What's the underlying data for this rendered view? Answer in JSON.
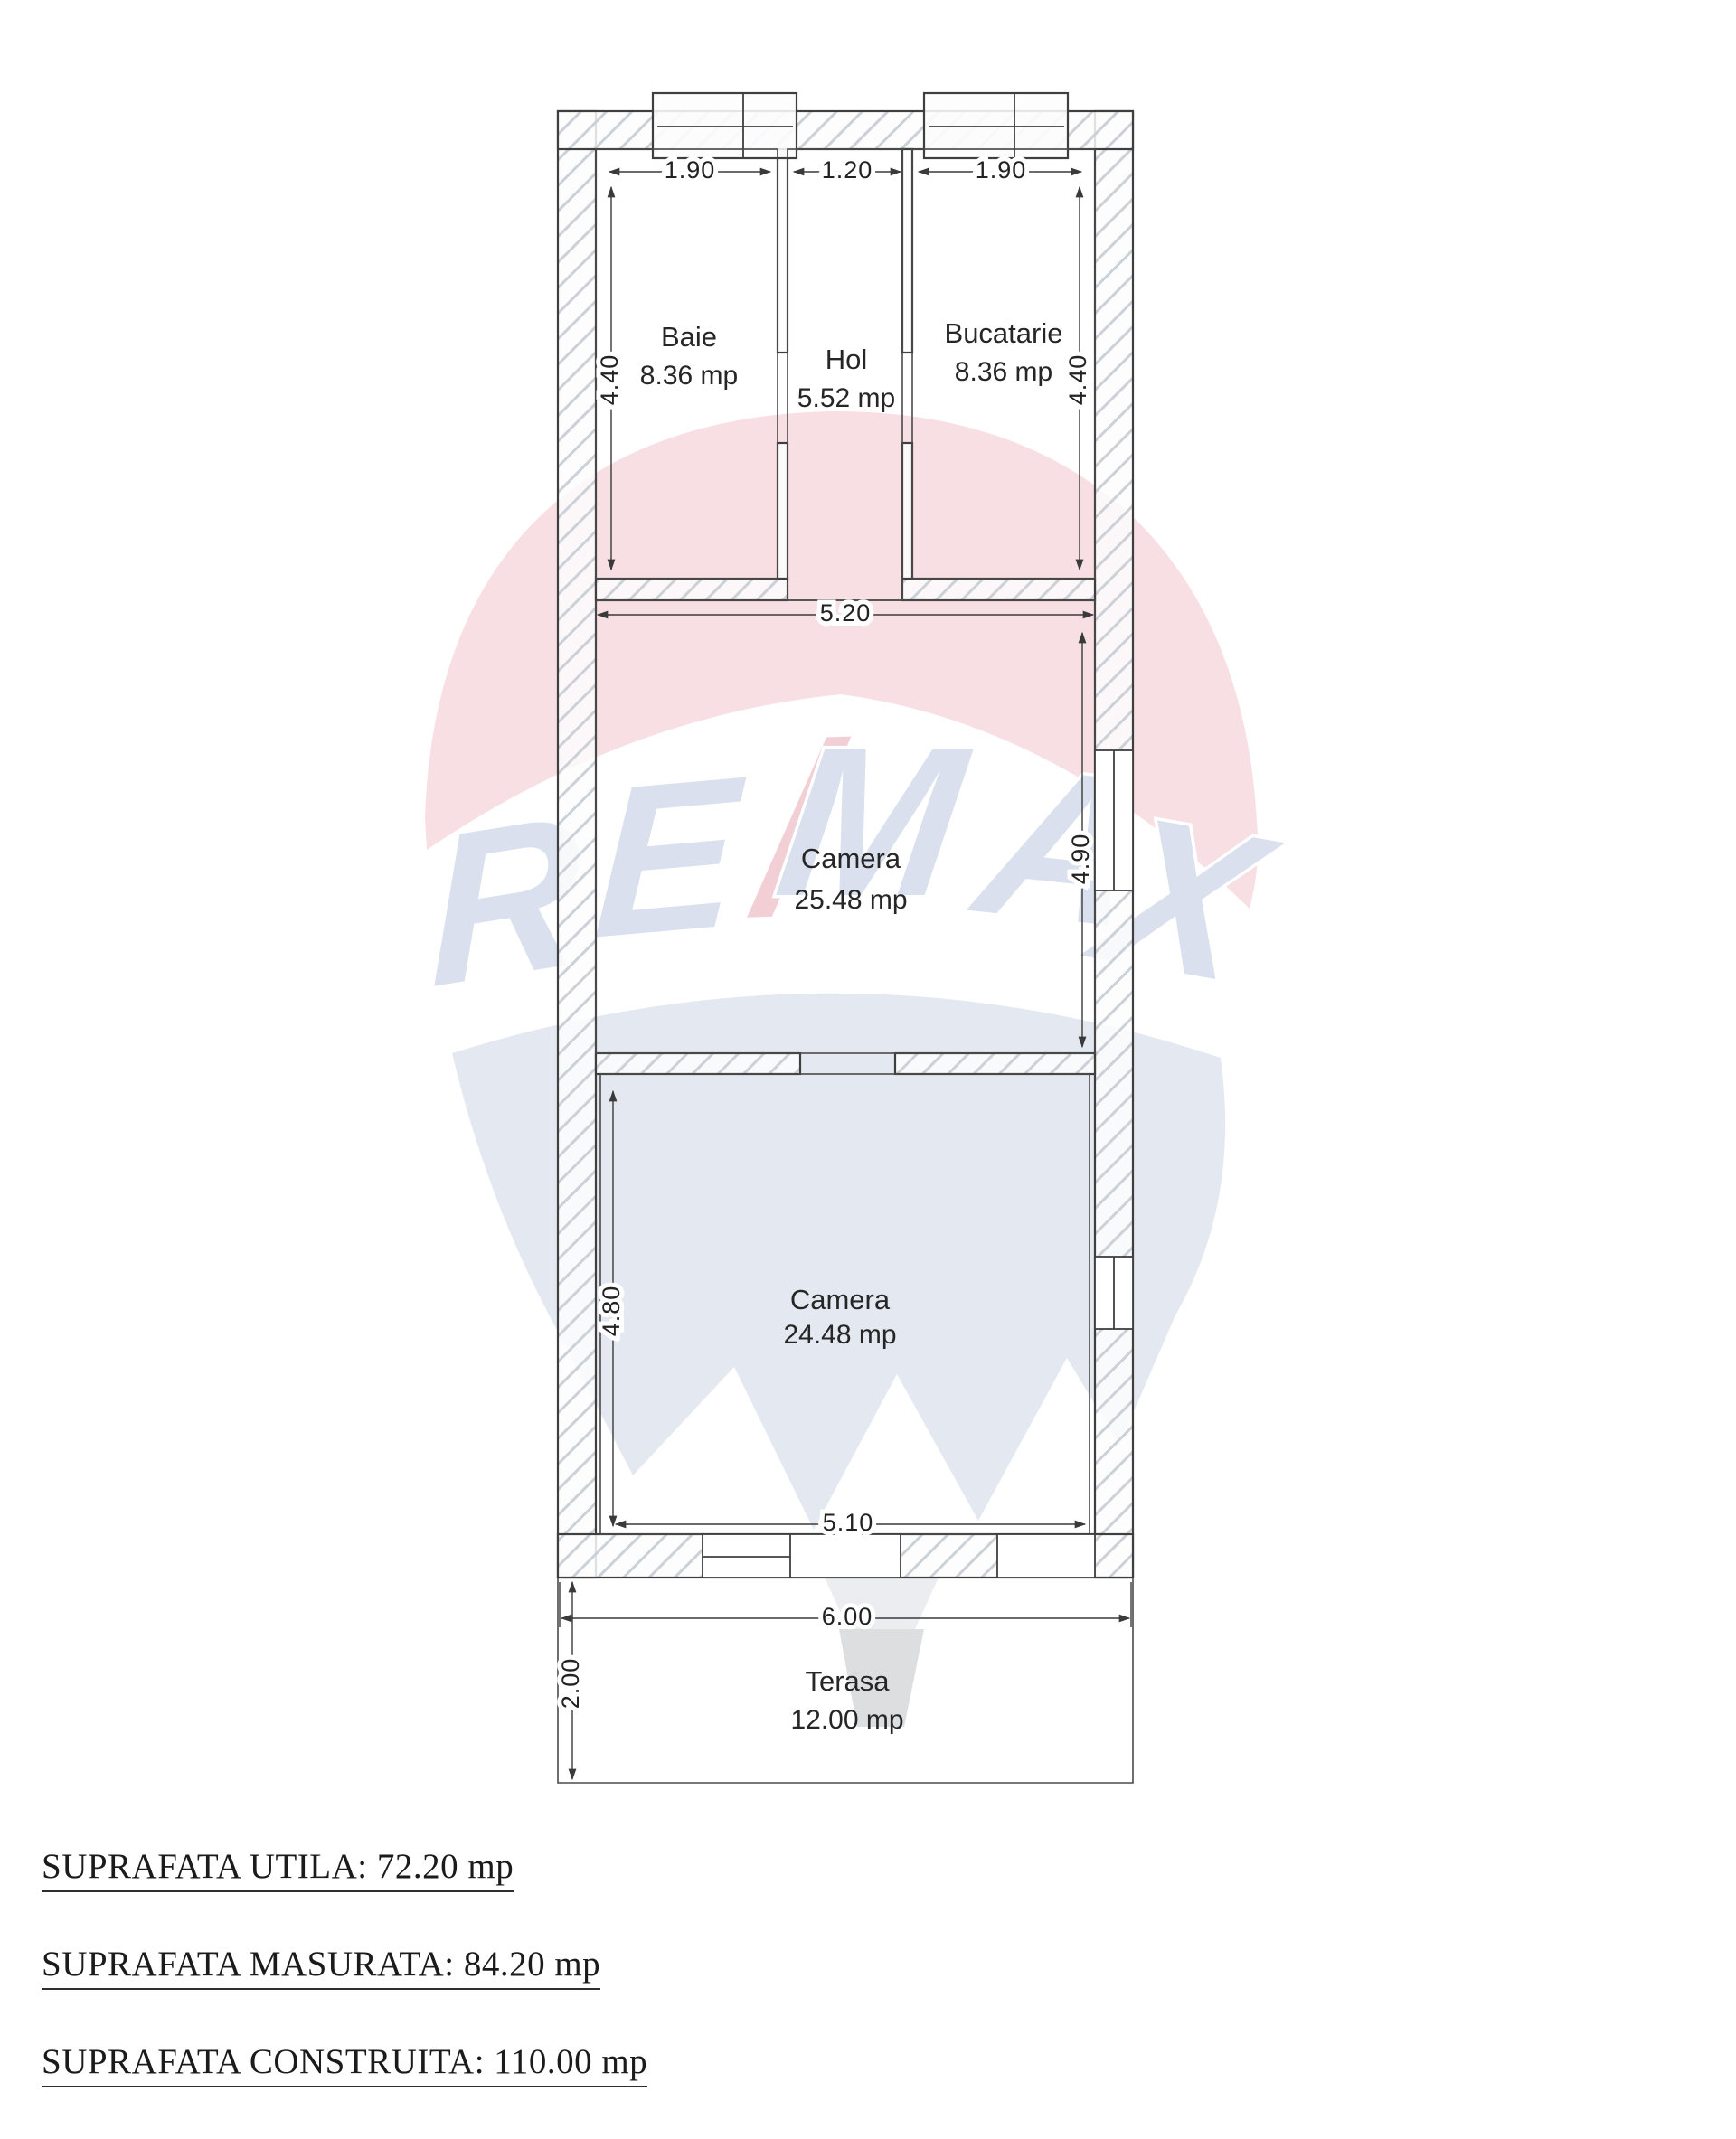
{
  "watermark": {
    "brand": "RE/MAX",
    "letters": [
      "R",
      "E",
      "/",
      "M",
      "A",
      "X"
    ],
    "colors": {
      "dome_pink": "#f7dee2",
      "letters_blue": "#d8dfec",
      "slash_pink": "#f2cdd3",
      "body_blue": "#e3e8f1",
      "basket_gray": "#dcdddf"
    }
  },
  "rooms": {
    "baie": {
      "name": "Baie",
      "area": "8.36 mp"
    },
    "hol": {
      "name": "Hol",
      "area": "5.52 mp"
    },
    "bucatarie": {
      "name": "Bucatarie",
      "area": "8.36 mp"
    },
    "camera_mare": {
      "name": "Camera",
      "area": "25.48 mp"
    },
    "camera_mica": {
      "name": "Camera",
      "area": "24.48 mp"
    },
    "terasa": {
      "name": "Terasa",
      "area": "12.00 mp"
    }
  },
  "dimensions": {
    "baie_width": "1.90",
    "hol_width": "1.20",
    "bucatarie_width": "1.90",
    "baie_height": "4.40",
    "bucatarie_height": "4.40",
    "camera_mare_width": "5.20",
    "camera_mare_height": "4.90",
    "camera_mica_height": "4.80",
    "camera_mica_width": "5.10",
    "house_width": "6.00",
    "terasa_height": "2.00"
  },
  "summary": {
    "utila": "SUPRAFATA UTILA: 72.20 mp",
    "masurata": "SUPRAFATA MASURATA: 84.20 mp",
    "construita": "SUPRAFATA CONSTRUITA: 110.00 mp"
  }
}
